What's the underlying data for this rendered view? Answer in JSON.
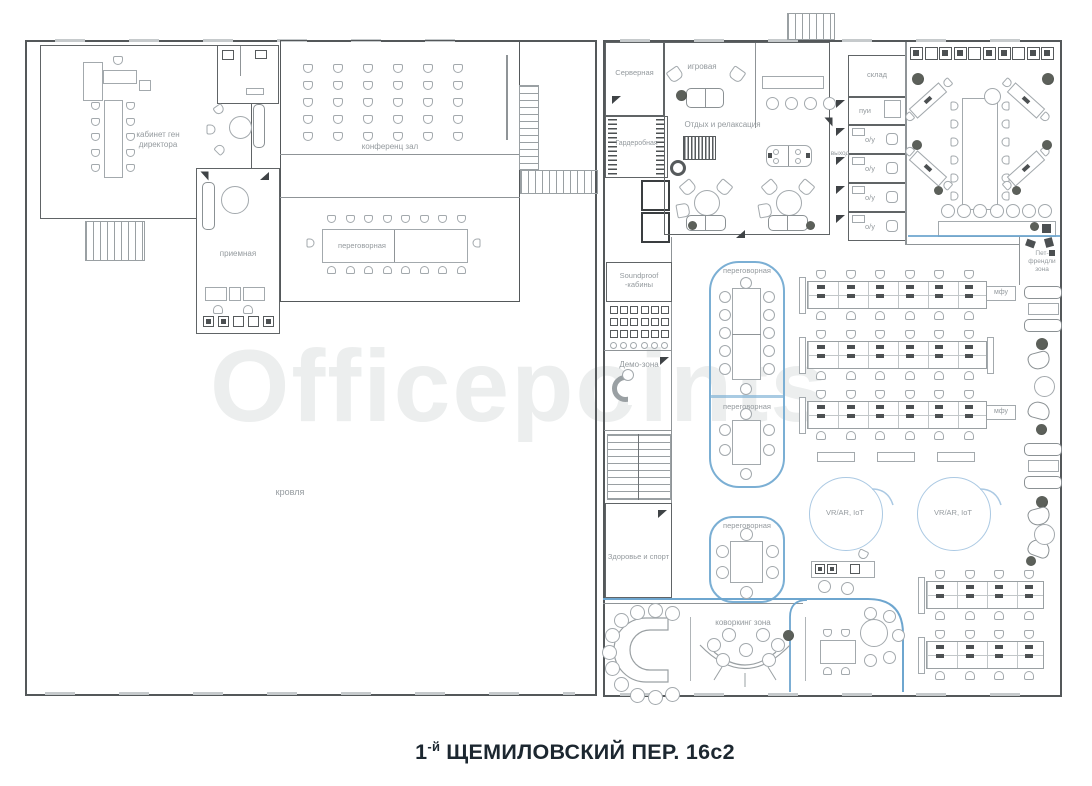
{
  "watermark": "Officepoints",
  "title": {
    "prefix": "1",
    "sup": "-й",
    "rest": "ЩЕМИЛОВСКИЙ ПЕР. 16с2"
  },
  "left_building": {
    "rooms": {
      "director": "кабинет ген директора",
      "reception": "приемная",
      "conference_hall": "конференц зал",
      "meeting": "переговорная",
      "roof": "кровля"
    }
  },
  "right_building": {
    "rooms": {
      "server": "Серверная",
      "game": "игровая",
      "relax": "Отдых и релаксация",
      "wardrobe": "Гардеробная",
      "storage": "склад",
      "cleaning": "пуи",
      "wc": "о/у",
      "exit": "выход",
      "kitchen": "кухня",
      "pet": "Пет-френдли зона",
      "soundproof": "Soundproof -кабины",
      "demo": "Демо-зона",
      "health": "Здоровье и спорт",
      "meeting": "переговорная",
      "coworking": "коворкинг зона",
      "vr": "VR/AR, IoT",
      "printer": "мфу"
    }
  },
  "colors": {
    "accent_blue": "#7bafd4",
    "accent_blue_light": "#abc9e3",
    "wall_gray": "#54585a",
    "label_gray": "#949a9e",
    "title_color": "#1c2730",
    "watermark_gray": "#eceeee"
  }
}
